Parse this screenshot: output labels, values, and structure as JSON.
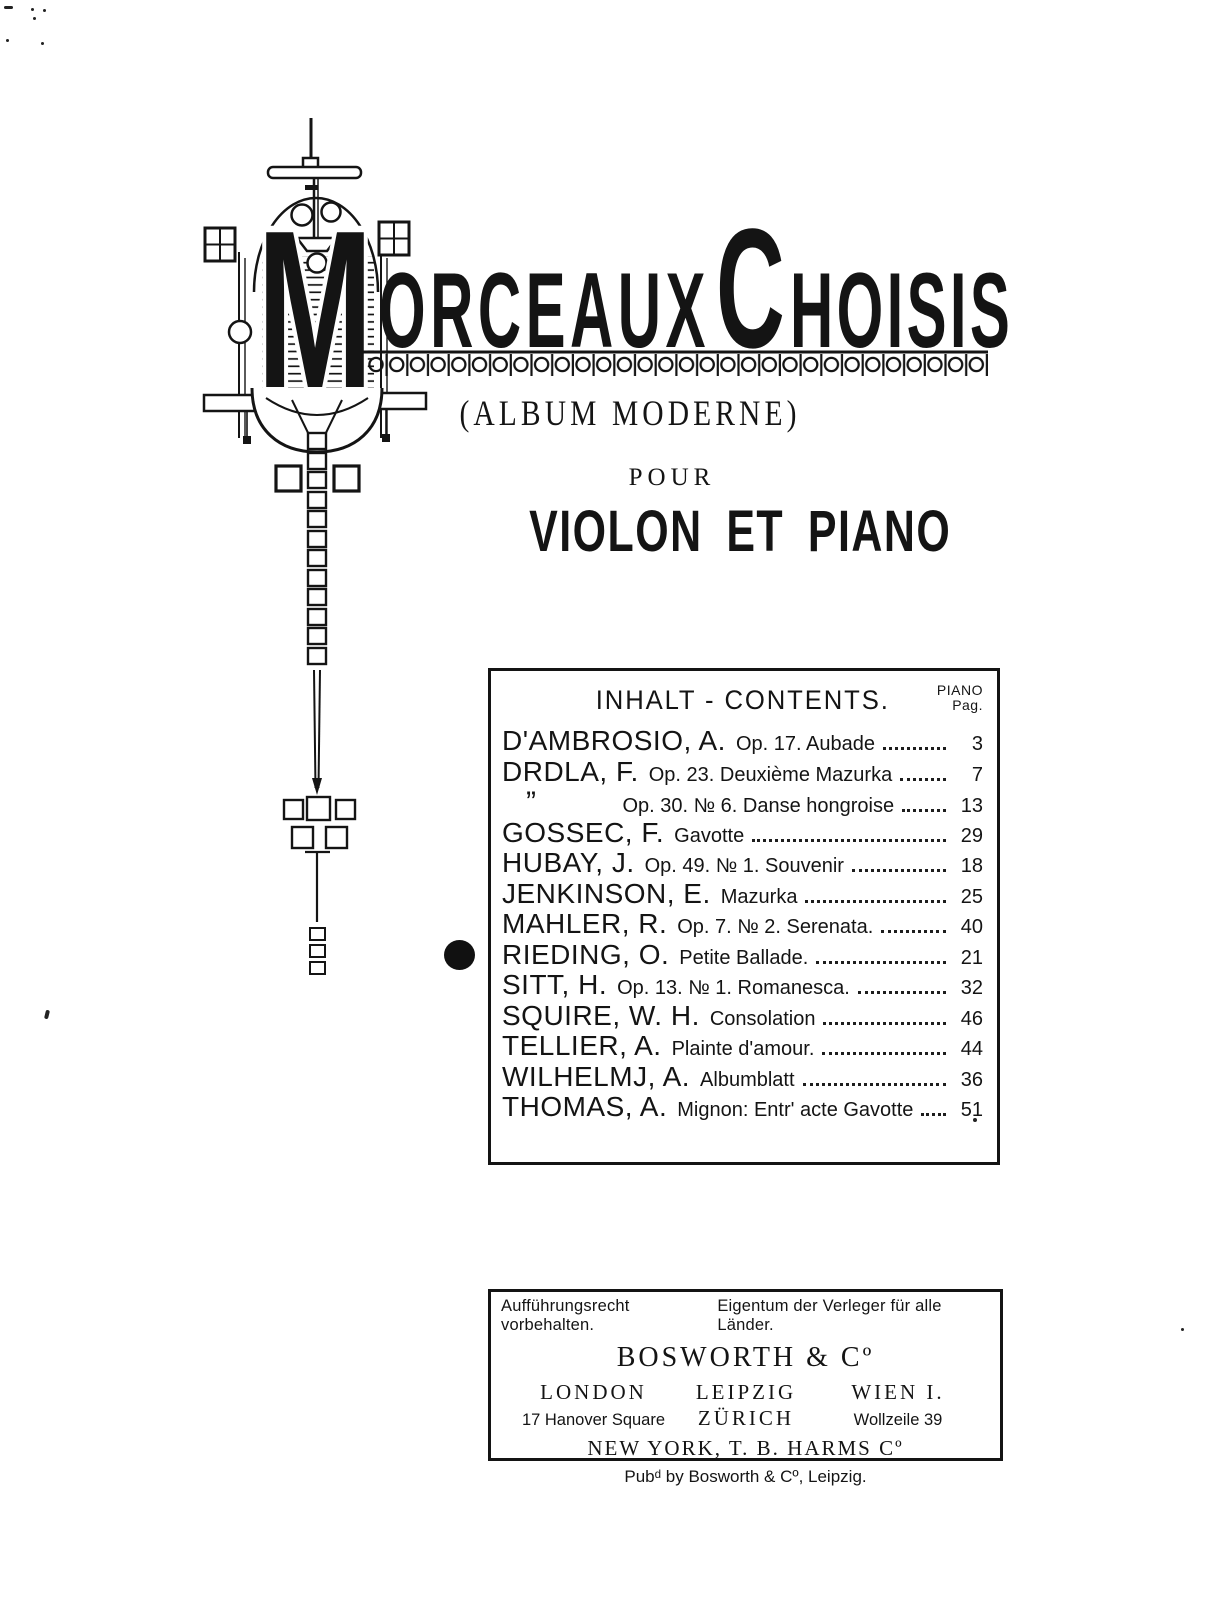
{
  "title": {
    "m": "M",
    "orceaux": "ORCEAUX",
    "c": "C",
    "hoisis": "HOISIS"
  },
  "header": {
    "subtitle": "(ALBUM  MODERNE)",
    "pour": "POUR",
    "instrumentation": "VIOLON ET PIANO"
  },
  "decor": {
    "ornament": "art-nouveau-violin-lyre-ornament",
    "band": "circle-chain-border-band",
    "marker": "filled-dot-selection-marker"
  },
  "colors": {
    "ink": "#141414",
    "paper": "#ffffff"
  },
  "contents": {
    "heading": "INHALT - CONTENTS.",
    "page_col_line1": "PIANO",
    "page_col_line2": "Pag.",
    "rows": [
      {
        "composer": "D'AMBROSIO, A.",
        "work": "Op. 17. Aubade",
        "page": "3"
      },
      {
        "composer": "DRDLA, F.",
        "work": "Op. 23. Deuxième Mazurka",
        "page": "7"
      },
      {
        "composer": "”",
        "work": "Op. 30. № 6. Danse hongroise",
        "page": "13",
        "ditto": true
      },
      {
        "composer": "GOSSEC, F.",
        "work": "Gavotte",
        "page": "29"
      },
      {
        "composer": "HUBAY, J.",
        "work": "Op. 49. № 1. Souvenir",
        "page": "18"
      },
      {
        "composer": "JENKINSON, E.",
        "work": "Mazurka",
        "page": "25"
      },
      {
        "composer": "MAHLER, R.",
        "work": "Op. 7. № 2. Serenata.",
        "page": "40"
      },
      {
        "composer": "RIEDING, O.",
        "work": "Petite Ballade.",
        "page": "21",
        "marked": true
      },
      {
        "composer": "SITT, H.",
        "work": "Op. 13. № 1. Romanesca.",
        "page": "32"
      },
      {
        "composer": "SQUIRE, W. H.",
        "work": "Consolation",
        "page": "46"
      },
      {
        "composer": "TELLIER, A.",
        "work": "Plainte d'amour.",
        "page": "44"
      },
      {
        "composer": "WILHELMJ, A.",
        "work": "Albumblatt",
        "page": "36"
      },
      {
        "composer": "THOMAS, A.",
        "work": "Mignon:  Entr' acte Gavotte",
        "page": "51"
      }
    ]
  },
  "publisher": {
    "rights_left": "Aufführungsrecht vorbehalten.",
    "rights_right": "Eigentum der Verleger für alle Länder.",
    "name": "BOSWORTH & Cº",
    "columns": [
      {
        "top": "LONDON",
        "bottom": "17 Hanover Square"
      },
      {
        "top": "LEIPZIG",
        "bottom": "ZÜRICH"
      },
      {
        "top": "WIEN I.",
        "bottom": "Wollzeile 39"
      }
    ],
    "new_york": "NEW YORK, T. B. HARMS Cº",
    "imprint": "Pubᵈ by Bosworth & Cº, Leipzig."
  }
}
